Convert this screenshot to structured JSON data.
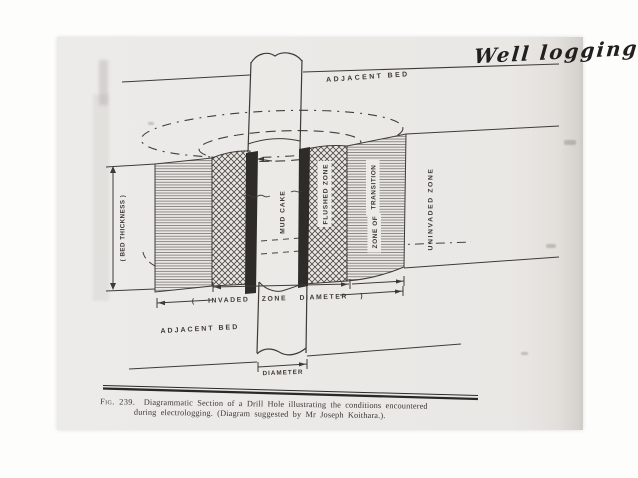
{
  "page": {
    "handwritten_note": "Well logging",
    "caption": {
      "figure_label": "Fig. 239.",
      "title_line1": "Diagrammatic Section of a Drill Hole illustrating the conditions encountered",
      "title_line2": "during  electrologging.   (Diagram  suggested  by  Mr  Joseph  Koithara.)."
    }
  },
  "diagram": {
    "labels": {
      "adjacent_bed_top": "ADJACENT BED",
      "adjacent_bed_bottom": "ADJACENT BED",
      "mud_cake": "MUD CAKE",
      "flushed_zone": "FLUSHED ZONE",
      "zone_of": "ZONE OF",
      "transition": "TRANSITION",
      "uninvaded_zone": "UNINVADED ZONE",
      "bed_thickness": "( BED THICKNESS )",
      "invaded_zone_diameter": "( INVADED  ZONE  DIAMETER )",
      "diameter": "DIAMETER"
    },
    "zones": [
      {
        "name": "mud-cake",
        "fill": "solid-dark"
      },
      {
        "name": "flushed-zone",
        "fill": "cross-hatch"
      },
      {
        "name": "zone-of-transition",
        "fill": "horizontal-hatch"
      },
      {
        "name": "uninvaded-zone",
        "fill": "blank"
      }
    ],
    "colors": {
      "ink": "#3d3b38",
      "page": "#eae8e5",
      "mud_cake": "#2e2c29",
      "hatch": "#55514d"
    }
  }
}
